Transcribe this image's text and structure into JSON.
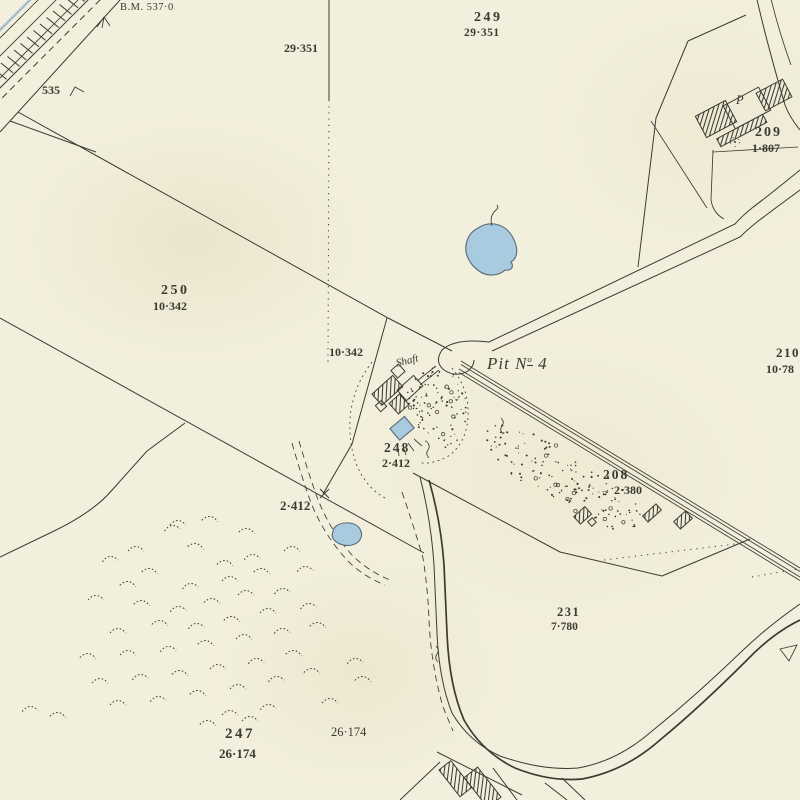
{
  "map": {
    "colors": {
      "paper": "#f2efdc",
      "ink": "#3c3b33",
      "water_fill": "#a9cbe0",
      "water_stroke": "#5a6a74",
      "railway_blue": "#96b3c8"
    },
    "labels": {
      "bench_mark": "B.M. 537·0",
      "road_number_535": "535",
      "area_29_351_west": "29·351",
      "parcel_249": {
        "number": "249",
        "area": "29·351"
      },
      "building_p": "P",
      "parcel_209": {
        "number": "209",
        "area": "1·807"
      },
      "parcel_250": {
        "number": "250",
        "area": "10·342"
      },
      "area_10_342_mid": "10·342",
      "pit": {
        "prefix": "Pit N",
        "sup": "o",
        "suffix": " 4"
      },
      "shaft": "Shaft",
      "parcel_248": {
        "number": "248",
        "area": "2·412"
      },
      "area_2_412": "2·412",
      "parcel_210_clipped": {
        "number": "210",
        "area": "10·78"
      },
      "parcel_208": {
        "number": "208",
        "area": "2·380"
      },
      "parcel_231": {
        "number": "231",
        "area": "7·780"
      },
      "parcel_247": {
        "number": "247",
        "area": "26·174"
      },
      "area_26_174_east": "26·174"
    },
    "railway_hatch": {
      "d1": 64,
      "d2": 86,
      "step": 6.5
    },
    "stipple": [
      {
        "cx": 437,
        "cy": 407,
        "rx": 30,
        "ry": 42,
        "rot": -8,
        "count": 120,
        "seed": 7
      },
      {
        "cx": 563,
        "cy": 478,
        "rx": 92,
        "ry": 27,
        "rot": 31,
        "count": 190,
        "seed": 11
      }
    ],
    "tufts": [
      [
        172,
        527,
        -8
      ],
      [
        247,
        530,
        6
      ],
      [
        136,
        548,
        0
      ],
      [
        196,
        545,
        10
      ],
      [
        110,
        558,
        -6
      ],
      [
        225,
        562,
        4
      ],
      [
        150,
        570,
        8
      ],
      [
        252,
        556,
        -5
      ],
      [
        292,
        548,
        0
      ],
      [
        128,
        583,
        5
      ],
      [
        190,
        585,
        -8
      ],
      [
        230,
        578,
        0
      ],
      [
        262,
        570,
        7
      ],
      [
        305,
        568,
        -4
      ],
      [
        96,
        597,
        0
      ],
      [
        142,
        602,
        6
      ],
      [
        178,
        608,
        -5
      ],
      [
        212,
        600,
        3
      ],
      [
        246,
        592,
        0
      ],
      [
        282,
        590,
        -7
      ],
      [
        160,
        622,
        4
      ],
      [
        118,
        630,
        0
      ],
      [
        196,
        625,
        -6
      ],
      [
        232,
        618,
        5
      ],
      [
        268,
        610,
        0
      ],
      [
        308,
        605,
        -8
      ],
      [
        88,
        655,
        3
      ],
      [
        128,
        652,
        0
      ],
      [
        168,
        648,
        -5
      ],
      [
        206,
        642,
        6
      ],
      [
        244,
        636,
        0
      ],
      [
        282,
        630,
        -4
      ],
      [
        318,
        624,
        5
      ],
      [
        100,
        680,
        0
      ],
      [
        140,
        676,
        -6
      ],
      [
        180,
        672,
        4
      ],
      [
        218,
        666,
        0
      ],
      [
        256,
        660,
        -5
      ],
      [
        294,
        652,
        6
      ],
      [
        118,
        702,
        0
      ],
      [
        158,
        698,
        -4
      ],
      [
        198,
        692,
        5
      ],
      [
        238,
        686,
        0
      ],
      [
        276,
        678,
        -6
      ],
      [
        312,
        670,
        3
      ],
      [
        230,
        712,
        0
      ],
      [
        268,
        706,
        -5
      ],
      [
        208,
        722,
        4
      ],
      [
        250,
        718,
        0
      ],
      [
        30,
        708,
        -4
      ],
      [
        58,
        714,
        5
      ],
      [
        330,
        700,
        0
      ],
      [
        355,
        660,
        -5
      ],
      [
        363,
        678,
        4
      ],
      [
        178,
        522,
        0
      ],
      [
        210,
        518,
        5
      ]
    ]
  }
}
